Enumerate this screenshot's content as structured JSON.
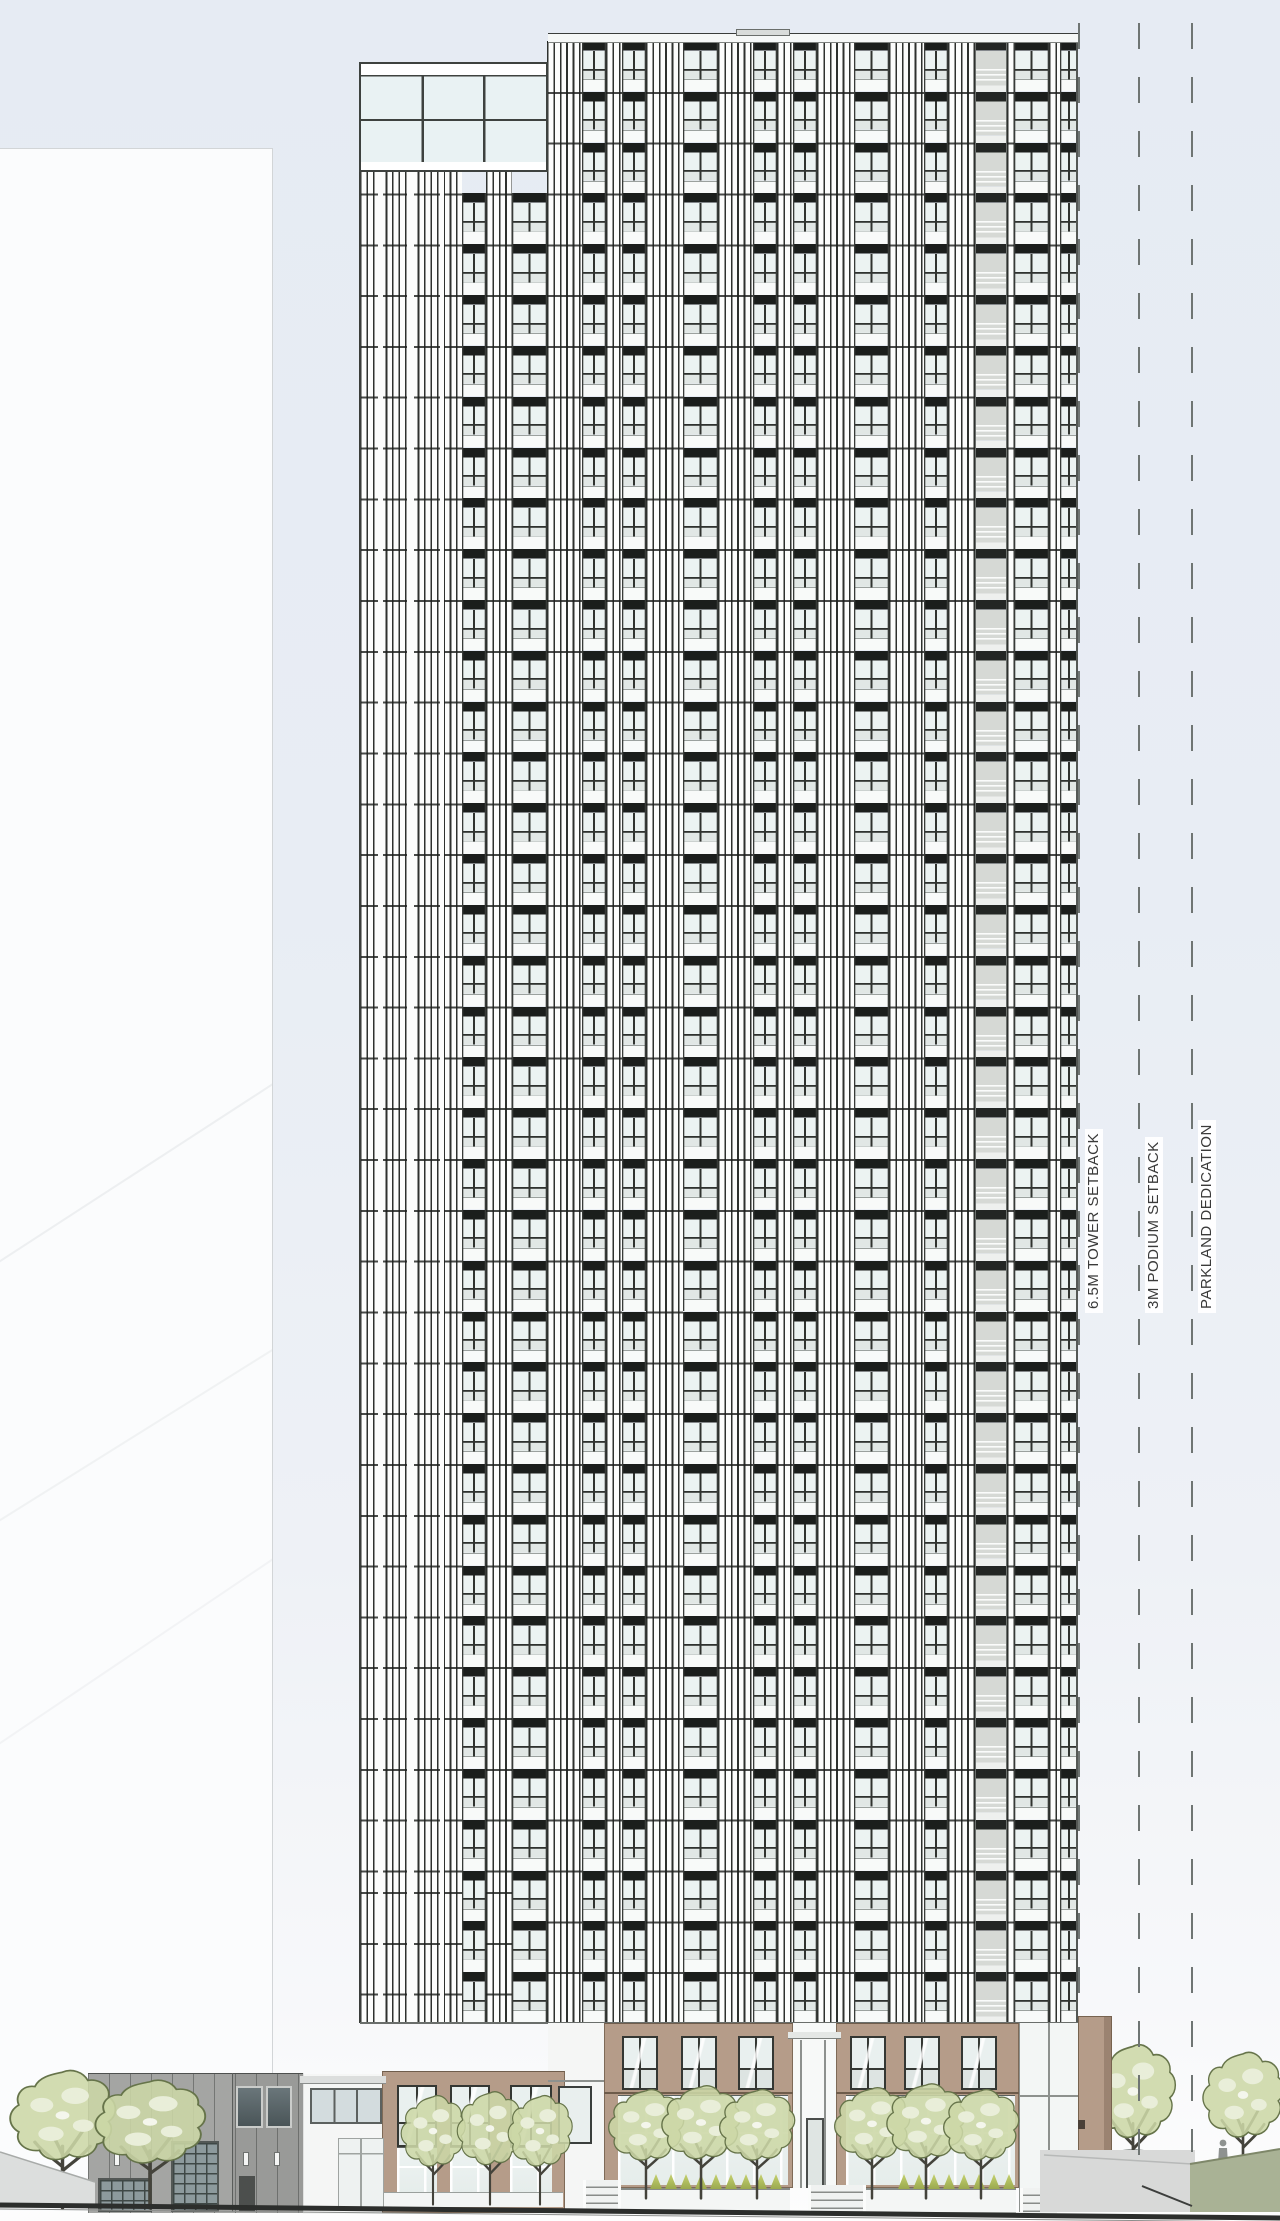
{
  "annotations": {
    "tower_setback": {
      "label": "6.5M TOWER SETBACK"
    },
    "podium_setback": {
      "label": "3M PODIUM SETBACK"
    },
    "parkland": {
      "label": "PARKLAND DEDICATION"
    }
  },
  "palette": {
    "sky": "#e7ecf4",
    "background_building": "#fbfcfd",
    "spandrel_black": "#1b1e1c",
    "stripe_dark": "#2e312e",
    "stripe_light": "#fcfdfc",
    "glass": "#ecf3f2",
    "glass_lower": "#e1e7e5",
    "balcony_panel": "#d6d9d5",
    "podium_tan": "#b59c89",
    "podium_tan_shade": "#9b8371",
    "podium_glass": "#edf3f2",
    "gray_building": "#a4a5a3",
    "gray_building_dark": "#9a9b99",
    "tree_canopy": "#ccd7a6",
    "tree_edge": "#66744a",
    "tree_patch": "#e9eed9",
    "bush": "#c3d06e",
    "grass": "#a9b295",
    "ground_line": "#2c2e2c",
    "sidewalk": "#d8d9d8",
    "annotation_line": "#6f7573",
    "annotation_text": "#3a3a3a"
  },
  "scene": {
    "tower_floors": 39,
    "floor_pitch_px": 50.82,
    "setback_lines_x": {
      "tower": 1078,
      "podium": 1138,
      "parkland": 1191
    },
    "label_anchors": {
      "tower": 1085,
      "podium": 1145,
      "parkland": 1198,
      "baseline_y": 1313
    }
  }
}
